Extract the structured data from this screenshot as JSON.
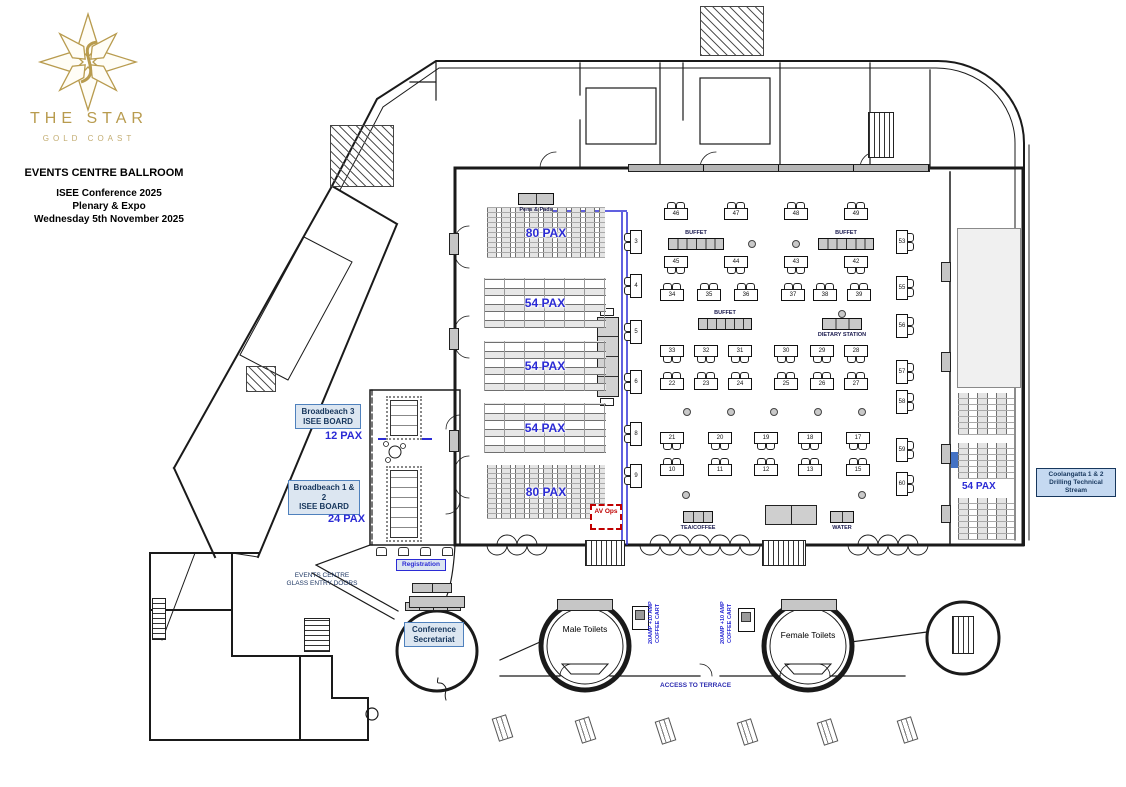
{
  "header": {
    "brand": "THE STAR",
    "brand_sub": "GOLD COAST",
    "title": "EVENTS CENTRE BALLROOM",
    "event_line1": "ISEE Conference 2025",
    "event_line2": "Plenary & Expo",
    "event_line3": "Wednesday 5th November 2025"
  },
  "colors": {
    "gold": "#B89B4E",
    "blue": "#2B2BD5",
    "navy": "#17375D",
    "label_bg": "#DCE6F1",
    "label_border": "#4F81BD",
    "cool_bg": "#C5D9F1",
    "red": "#C00000"
  },
  "plenary": {
    "blocks": [
      {
        "pax": "80 PAX",
        "kind": "theatre",
        "x": 487,
        "y": 207,
        "w": 118,
        "h": 51
      },
      {
        "pax": "54 PAX",
        "kind": "class",
        "x": 484,
        "y": 278,
        "w": 122,
        "h": 50
      },
      {
        "pax": "54 PAX",
        "kind": "class",
        "x": 484,
        "y": 341,
        "w": 122,
        "h": 50
      },
      {
        "pax": "54 PAX",
        "kind": "class",
        "x": 484,
        "y": 403,
        "w": 122,
        "h": 50
      },
      {
        "pax": "80 PAX",
        "kind": "theatre",
        "x": 487,
        "y": 465,
        "w": 118,
        "h": 54
      }
    ]
  },
  "broadbeach": {
    "room3_line1": "Broadbeach 3",
    "room3_line2": "ISEE BOARD",
    "room3_pax": "12 PAX",
    "room12_line1": "Broadbeach 1 & 2",
    "room12_line2": "ISEE BOARD",
    "room12_pax": "24 PAX"
  },
  "coolangatta": {
    "line1": "Coolangatta 1 & 2",
    "line2": "Drilling Technical Stream",
    "pax": "54 PAX",
    "blocks": [
      {
        "x": 958,
        "y": 393,
        "w": 56,
        "h": 42
      },
      {
        "x": 958,
        "y": 443,
        "w": 56,
        "h": 36
      },
      {
        "x": 958,
        "y": 498,
        "w": 56,
        "h": 42
      }
    ]
  },
  "expo": {
    "tables": [
      {
        "n": "46",
        "x": 664,
        "y": 208,
        "c": "ct"
      },
      {
        "n": "47",
        "x": 724,
        "y": 208,
        "c": "ct"
      },
      {
        "n": "48",
        "x": 784,
        "y": 208,
        "c": "ct"
      },
      {
        "n": "49",
        "x": 844,
        "y": 208,
        "c": "ct"
      },
      {
        "n": "45",
        "x": 664,
        "y": 256,
        "c": "cb"
      },
      {
        "n": "44",
        "x": 724,
        "y": 256,
        "c": "cb"
      },
      {
        "n": "43",
        "x": 784,
        "y": 256,
        "c": "cb"
      },
      {
        "n": "42",
        "x": 844,
        "y": 256,
        "c": "cb"
      },
      {
        "n": "34",
        "x": 660,
        "y": 289,
        "c": "ct"
      },
      {
        "n": "35",
        "x": 697,
        "y": 289,
        "c": "ct"
      },
      {
        "n": "36",
        "x": 734,
        "y": 289,
        "c": "ct"
      },
      {
        "n": "37",
        "x": 781,
        "y": 289,
        "c": "ct"
      },
      {
        "n": "38",
        "x": 813,
        "y": 289,
        "c": "ct"
      },
      {
        "n": "39",
        "x": 847,
        "y": 289,
        "c": "ct"
      },
      {
        "n": "33",
        "x": 660,
        "y": 345,
        "c": "cb"
      },
      {
        "n": "32",
        "x": 694,
        "y": 345,
        "c": "cb"
      },
      {
        "n": "31",
        "x": 728,
        "y": 345,
        "c": "cb"
      },
      {
        "n": "30",
        "x": 774,
        "y": 345,
        "c": "cb"
      },
      {
        "n": "29",
        "x": 810,
        "y": 345,
        "c": "cb"
      },
      {
        "n": "28",
        "x": 844,
        "y": 345,
        "c": "cb"
      },
      {
        "n": "22",
        "x": 660,
        "y": 378,
        "c": "ct"
      },
      {
        "n": "23",
        "x": 694,
        "y": 378,
        "c": "ct"
      },
      {
        "n": "24",
        "x": 728,
        "y": 378,
        "c": "ct"
      },
      {
        "n": "25",
        "x": 774,
        "y": 378,
        "c": "ct"
      },
      {
        "n": "26",
        "x": 810,
        "y": 378,
        "c": "ct"
      },
      {
        "n": "27",
        "x": 844,
        "y": 378,
        "c": "ct"
      },
      {
        "n": "21",
        "x": 660,
        "y": 432,
        "c": "cb"
      },
      {
        "n": "20",
        "x": 708,
        "y": 432,
        "c": "cb"
      },
      {
        "n": "19",
        "x": 754,
        "y": 432,
        "c": "cb"
      },
      {
        "n": "18",
        "x": 798,
        "y": 432,
        "c": "cb"
      },
      {
        "n": "17",
        "x": 846,
        "y": 432,
        "c": "cb"
      },
      {
        "n": "10",
        "x": 660,
        "y": 464,
        "c": "ct"
      },
      {
        "n": "11",
        "x": 708,
        "y": 464,
        "c": "ct"
      },
      {
        "n": "12",
        "x": 754,
        "y": 464,
        "c": "ct"
      },
      {
        "n": "13",
        "x": 798,
        "y": 464,
        "c": "ct"
      },
      {
        "n": "15",
        "x": 846,
        "y": 464,
        "c": "ct"
      },
      {
        "n": "3",
        "x": 630,
        "y": 230,
        "c": "cl",
        "v": 1
      },
      {
        "n": "4",
        "x": 630,
        "y": 274,
        "c": "cl",
        "v": 1
      },
      {
        "n": "5",
        "x": 630,
        "y": 320,
        "c": "cl",
        "v": 1
      },
      {
        "n": "6",
        "x": 630,
        "y": 370,
        "c": "cl",
        "v": 1
      },
      {
        "n": "8",
        "x": 630,
        "y": 422,
        "c": "cl",
        "v": 1
      },
      {
        "n": "9",
        "x": 630,
        "y": 464,
        "c": "cl",
        "v": 1
      },
      {
        "n": "53",
        "x": 896,
        "y": 230,
        "c": "cr",
        "v": 1
      },
      {
        "n": "55",
        "x": 896,
        "y": 276,
        "c": "cr",
        "v": 1
      },
      {
        "n": "56",
        "x": 896,
        "y": 314,
        "c": "cr",
        "v": 1
      },
      {
        "n": "57",
        "x": 896,
        "y": 360,
        "c": "cr",
        "v": 1
      },
      {
        "n": "58",
        "x": 896,
        "y": 390,
        "c": "cr",
        "v": 1
      },
      {
        "n": "59",
        "x": 896,
        "y": 438,
        "c": "cr",
        "v": 1
      },
      {
        "n": "60",
        "x": 896,
        "y": 472,
        "c": "cr",
        "v": 1
      }
    ],
    "stations": [
      {
        "label": "BUFFET",
        "x": 668,
        "y": 238,
        "w": 56,
        "cells": 6,
        "pos": "t"
      },
      {
        "label": "BUFFET",
        "x": 818,
        "y": 238,
        "w": 56,
        "cells": 6,
        "pos": "t"
      },
      {
        "label": "BUFFET",
        "x": 698,
        "y": 318,
        "w": 54,
        "cells": 6,
        "pos": "t"
      },
      {
        "label": "DIETARY STATION",
        "x": 822,
        "y": 318,
        "w": 40,
        "cells": 3,
        "pos": "b"
      },
      {
        "label": "TEA/COFFEE",
        "x": 683,
        "y": 511,
        "w": 30,
        "cells": 3,
        "pos": "b"
      },
      {
        "label": "WATER",
        "x": 830,
        "y": 511,
        "w": 24,
        "cells": 2,
        "pos": "b"
      },
      {
        "label": "Pens & Pads",
        "x": 518,
        "y": 193,
        "w": 36,
        "cells": 2,
        "pos": "b"
      }
    ],
    "dots": [
      [
        748,
        240
      ],
      [
        792,
        240
      ],
      [
        838,
        310
      ],
      [
        683,
        408
      ],
      [
        727,
        408
      ],
      [
        770,
        408
      ],
      [
        814,
        408
      ],
      [
        858,
        408
      ],
      [
        682,
        491
      ],
      [
        858,
        491
      ]
    ]
  },
  "labels": {
    "registration": "Registration",
    "av_ops": "AV Ops",
    "entry_line1": "EVENTS CENTRE",
    "entry_line2": "GLASS ENTRY DOORS",
    "secretariat_line1": "Conference",
    "secretariat_line2": "Secretariat",
    "male_toilets": "Male Toilets",
    "female_toilets": "Female Toilets",
    "access_terrace": "ACCESS TO TERRACE",
    "coffee_line1": "20AMP +10 AMP",
    "coffee_line2": "COFFEE CART"
  },
  "terrace_tables": [
    [
      495,
      716
    ],
    [
      578,
      718
    ],
    [
      658,
      719
    ],
    [
      740,
      720
    ],
    [
      820,
      720
    ],
    [
      900,
      718
    ]
  ]
}
